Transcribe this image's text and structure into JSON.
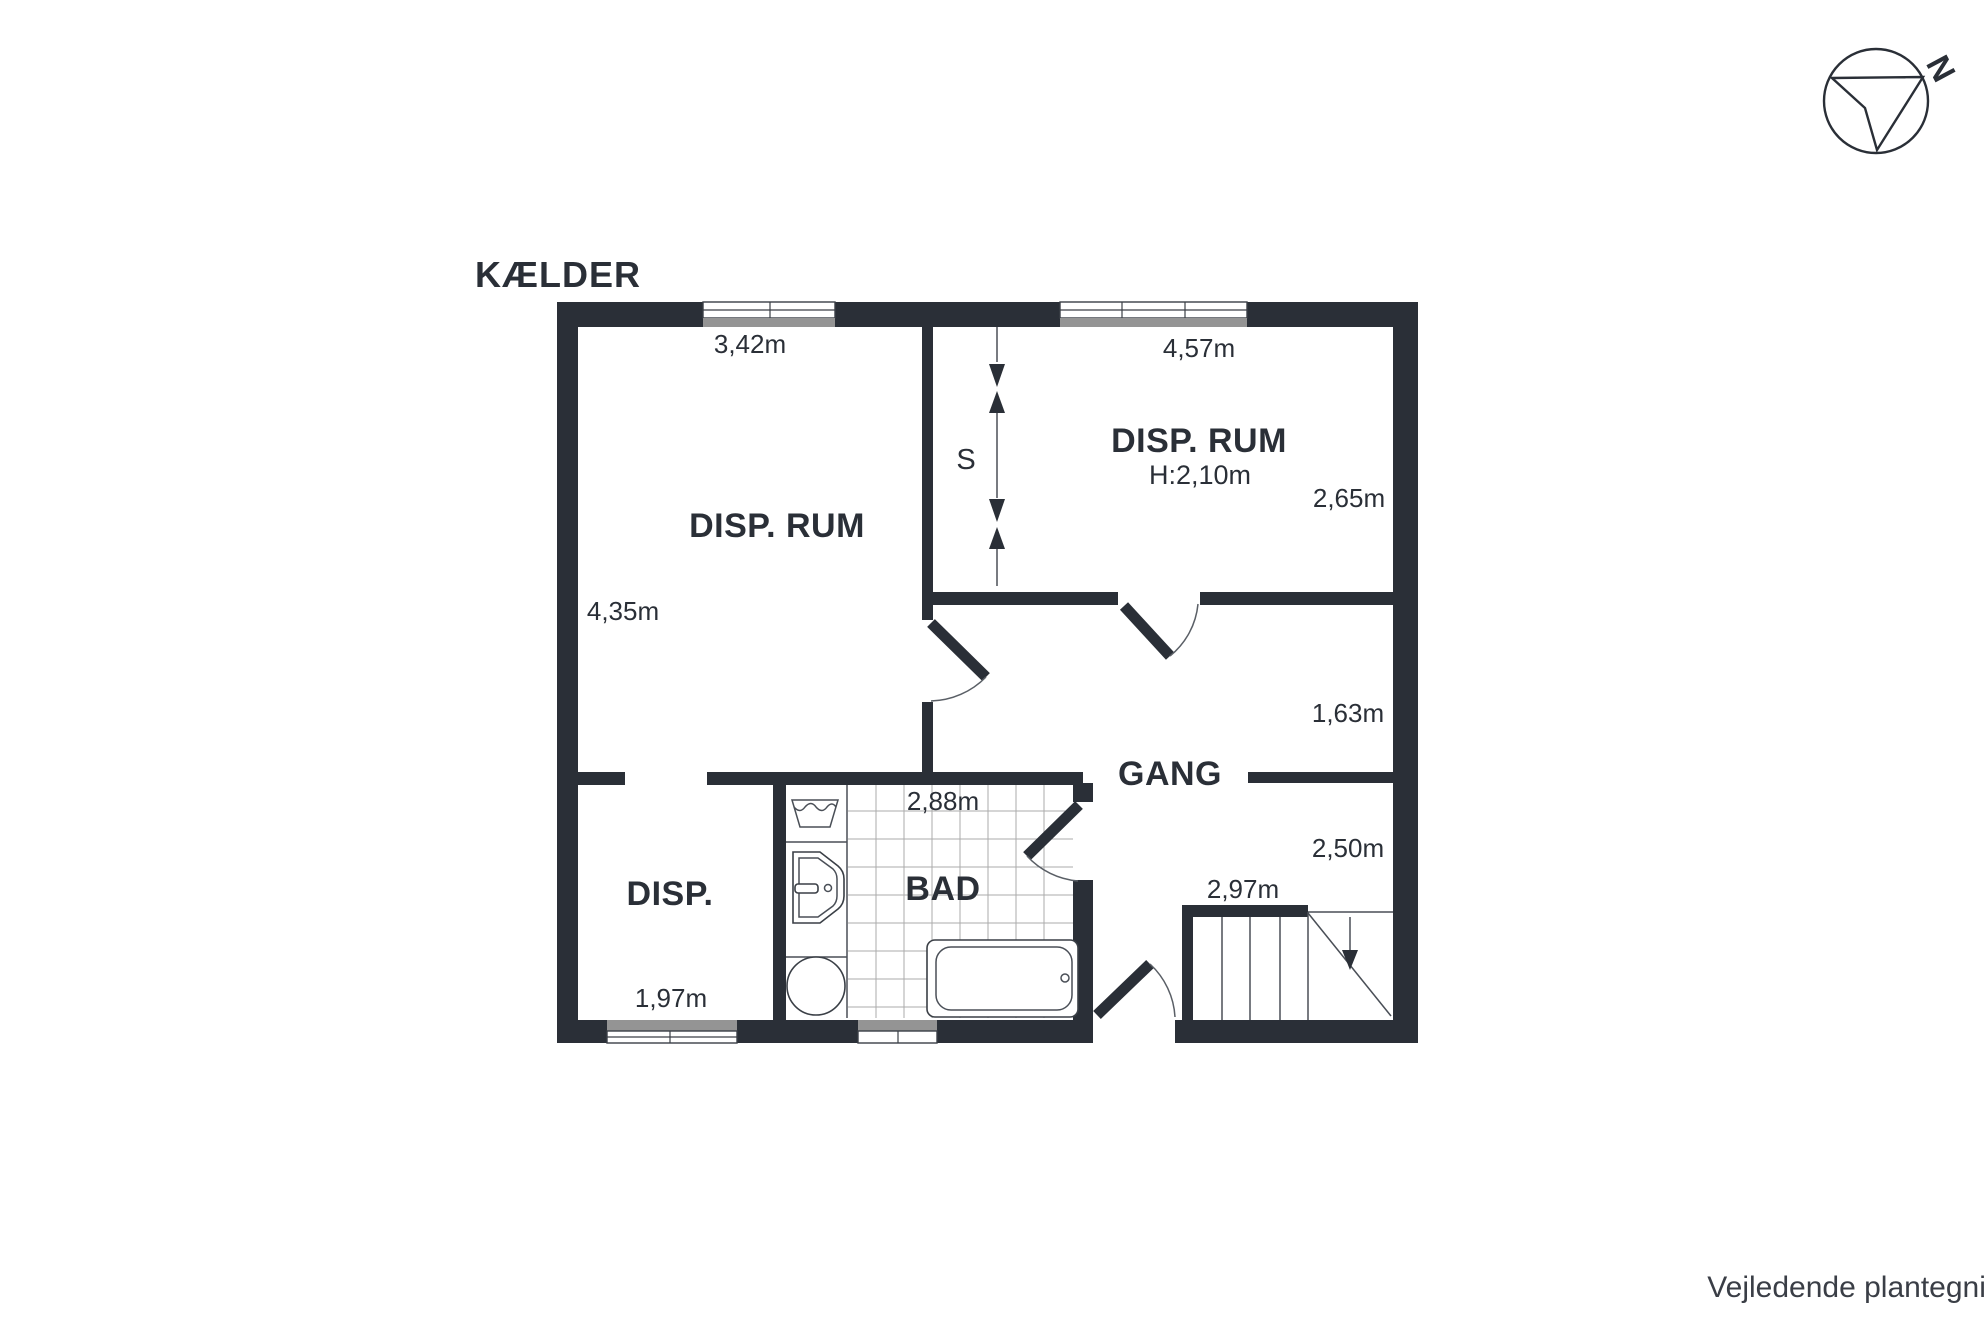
{
  "title": "KÆLDER",
  "compass": {
    "north_label": "N"
  },
  "footer": {
    "disclaimer": "Vejledende plantegning uden ansvar"
  },
  "rooms": {
    "disp_rum_left": {
      "name": "DISP. RUM",
      "width_dim": "3,42m",
      "depth_dim": "4,35m"
    },
    "disp_rum_right": {
      "name": "DISP. RUM",
      "ceiling_height": "H:2,10m",
      "width_dim": "4,57m",
      "depth_dim": "2,65m"
    },
    "gang": {
      "name": "GANG",
      "depth_dim": "1,63m",
      "east_width_dim": "2,50m"
    },
    "bad": {
      "name": "BAD",
      "width_dim": "2,88m"
    },
    "disp": {
      "name": "DISP.",
      "width_dim": "1,97m"
    },
    "stairs": {
      "width_dim": "2,97m"
    },
    "shaft": {
      "label": "S"
    }
  },
  "colors": {
    "wall": "#2a2f37",
    "window_gray": "#949494",
    "text": "#2a2f37",
    "thin_line": "#4a4f57",
    "tile_line": "#ababab"
  }
}
